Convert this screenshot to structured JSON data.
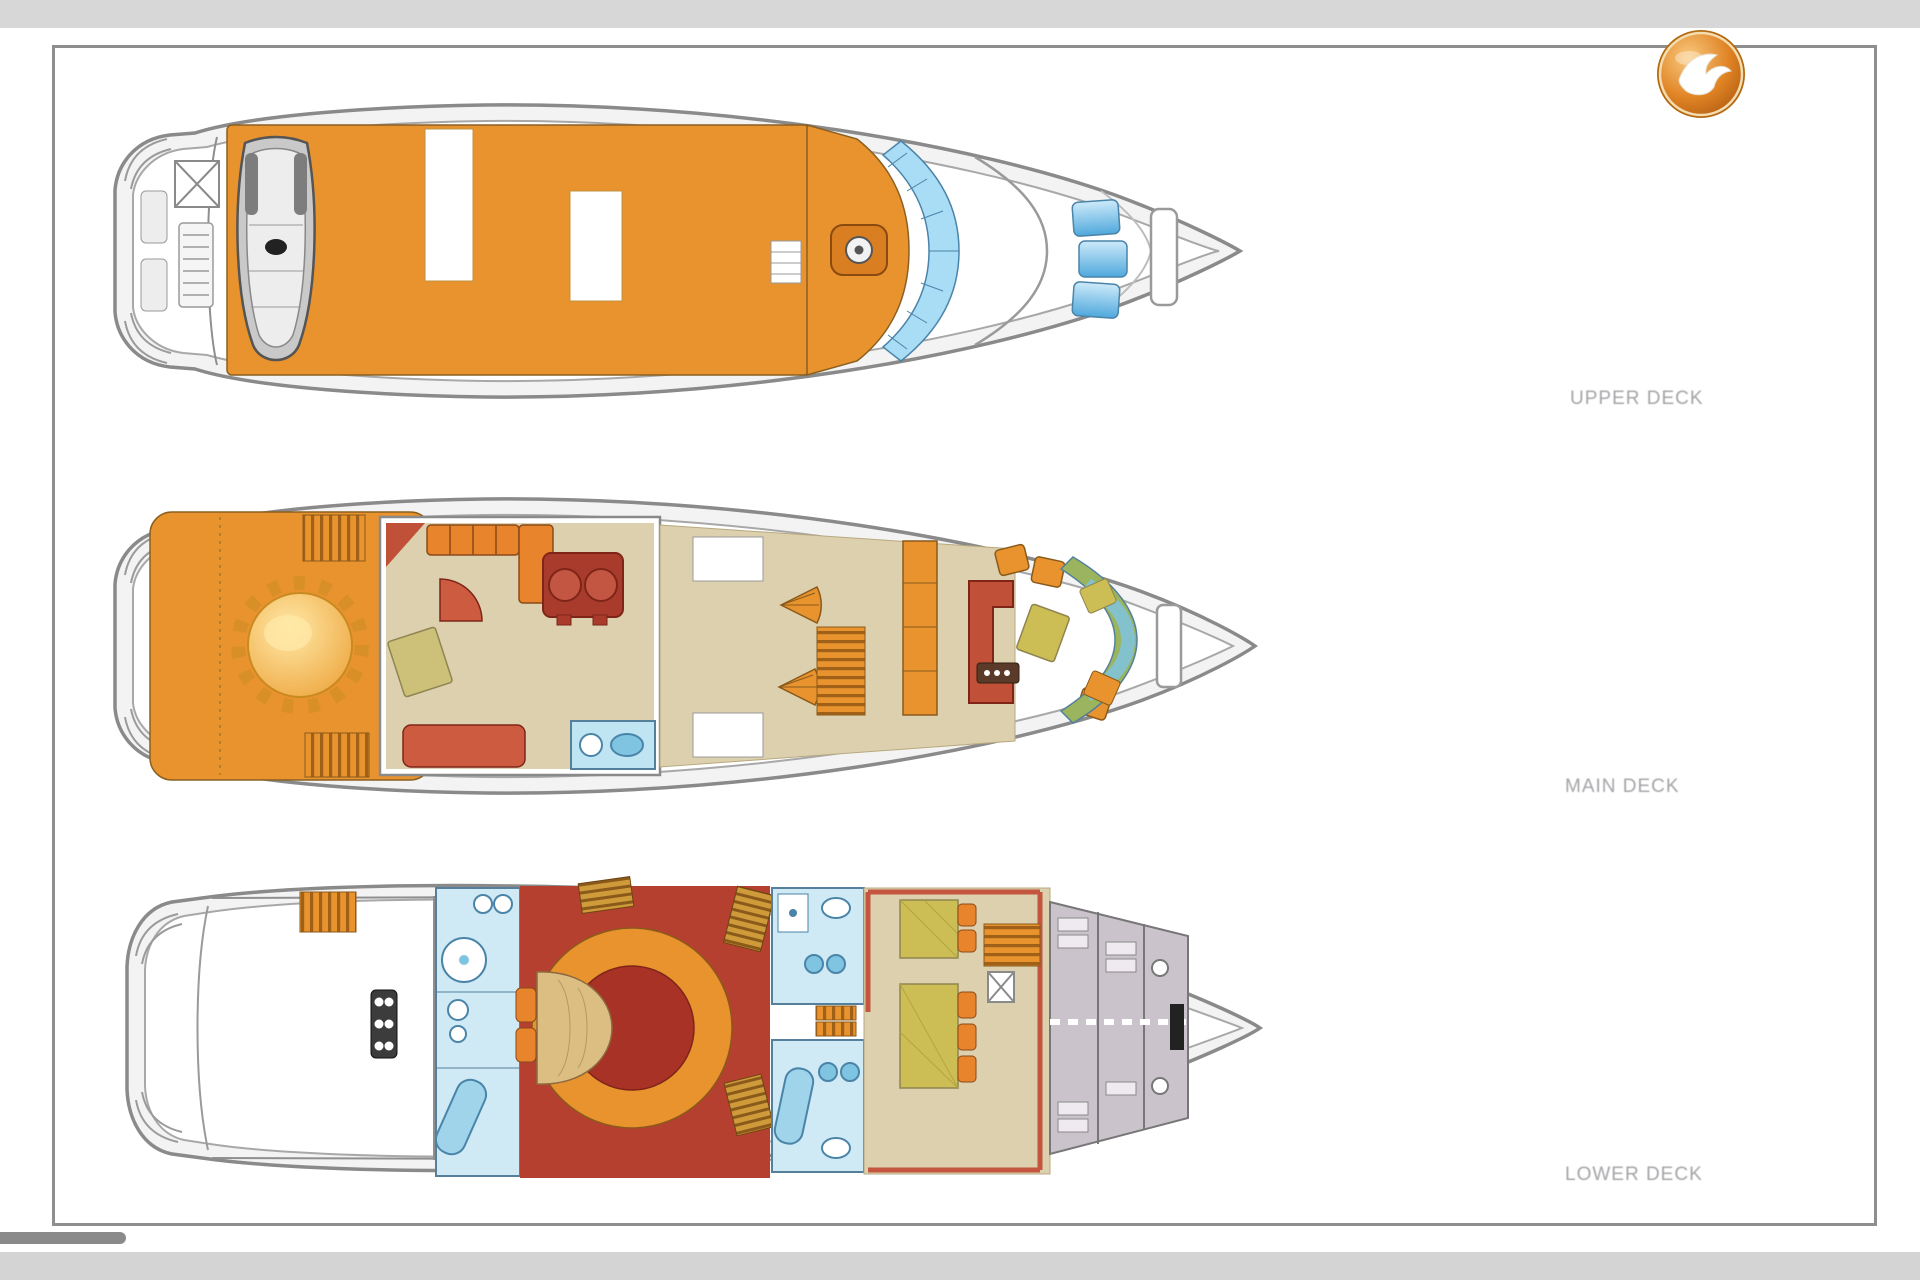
{
  "window": {
    "top_bar_color": "#d7d7d7",
    "bottom_bar_color": "#d4d4d4",
    "canvas_color": "#ffffff"
  },
  "document": {
    "kind": "yacht deck plans sheet",
    "sheet_border_color": "#8e8e8e",
    "sheet_background": "#ffffff"
  },
  "logo": {
    "icon": "seagull-falcon-icon",
    "circle_color": "#d9781e",
    "highlight_color": "#f6b964",
    "bird_color": "#ffffff"
  },
  "decks": [
    {
      "id": "upper-deck",
      "label": "UPPER DECK",
      "features": [
        "tender-boat",
        "sun-deck",
        "helm-console",
        "windshield-glass",
        "bow-skylights"
      ]
    },
    {
      "id": "main-deck",
      "label": "MAIN DECK",
      "features": [
        "aft-deck-round-dining-table",
        "twin-stairs",
        "salon",
        "galley",
        "spiral-stairs",
        "forward-dining",
        "bow-glass"
      ]
    },
    {
      "id": "lower-deck",
      "label": "LOWER DECK",
      "features": [
        "engine-room",
        "deck-hatch",
        "master-bathroom",
        "round-master-cabin",
        "guest-cabins",
        "crew-quarters"
      ]
    }
  ],
  "labels_color": "#a4a4a8",
  "palette": {
    "deck_orange": "#e8932e",
    "furniture_red": "#c05038",
    "dark_red": "#a93226",
    "carpet_beige": "#ddd0ae",
    "bath_blue": "#cfeaf5",
    "glass_blue": "#7fc4e0",
    "bed_olive": "#cdbd55",
    "crew_gray": "#cbc3cb",
    "hull_fill": "#f3f3f3",
    "outline_gray": "#8a8a8a",
    "table_gold": "#f2b844"
  },
  "scrollbar": {
    "orientation": "horizontal",
    "thumb_color": "#8a8a8a"
  }
}
